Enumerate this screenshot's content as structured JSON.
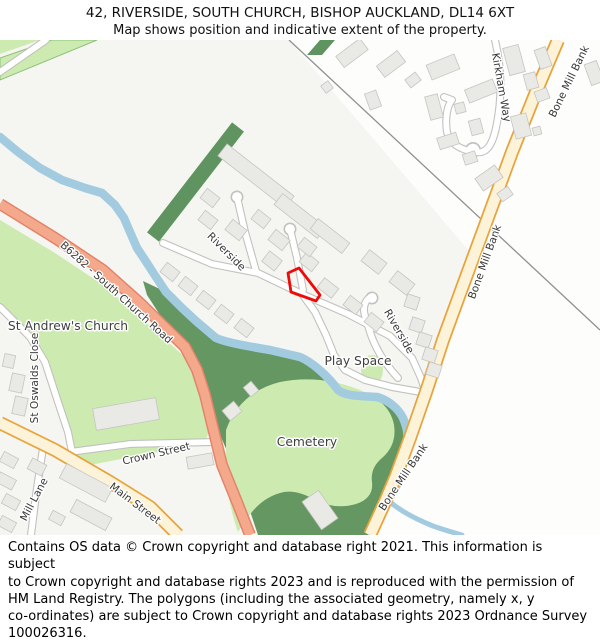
{
  "header": {
    "title": "42, RIVERSIDE, SOUTH CHURCH, BISHOP AUCKLAND, DL14 6XT",
    "subtitle": "Map shows position and indicative extent of the property."
  },
  "map": {
    "labels": {
      "st_andrews_church": "St Andrew's Church",
      "play_space": "Play Space",
      "cemetery": "Cemetery",
      "riverside_1": "Riverside",
      "riverside_2": "Riverside",
      "kirkham_way": "Kirkham Way",
      "bone_mill_bank_1": "Bone Mill Bank",
      "bone_mill_bank_2": "Bone Mill Bank",
      "bone_mill_bank_3": "Bone Mill Bank",
      "b6282": "B6282 - South Church Road",
      "crown_street": "Crown Street",
      "main_street": "Main Street",
      "mill_lane": "Mill Lane",
      "st_oswalds_close": "St Oswalds Close"
    },
    "colors": {
      "property_outline": "#ee0b0b",
      "primary_road": "#f5a98c",
      "secondary_road_fill": "#fcf3d8",
      "secondary_road_casing": "#e9a33c",
      "water": "#a2cbe0",
      "greenspace": "#cdebb0",
      "woodland": "#649762",
      "building": "#e9e9e6"
    }
  },
  "footer": {
    "lines": [
      "Contains OS data © Crown copyright and database right 2021. This information is subject",
      "to Crown copyright and database rights 2023 and is reproduced with the permission of",
      "HM Land Registry. The polygons (including the associated geometry, namely x, y",
      "co-ordinates) are subject to Crown copyright and database rights 2023 Ordnance Survey",
      "100026316."
    ]
  }
}
